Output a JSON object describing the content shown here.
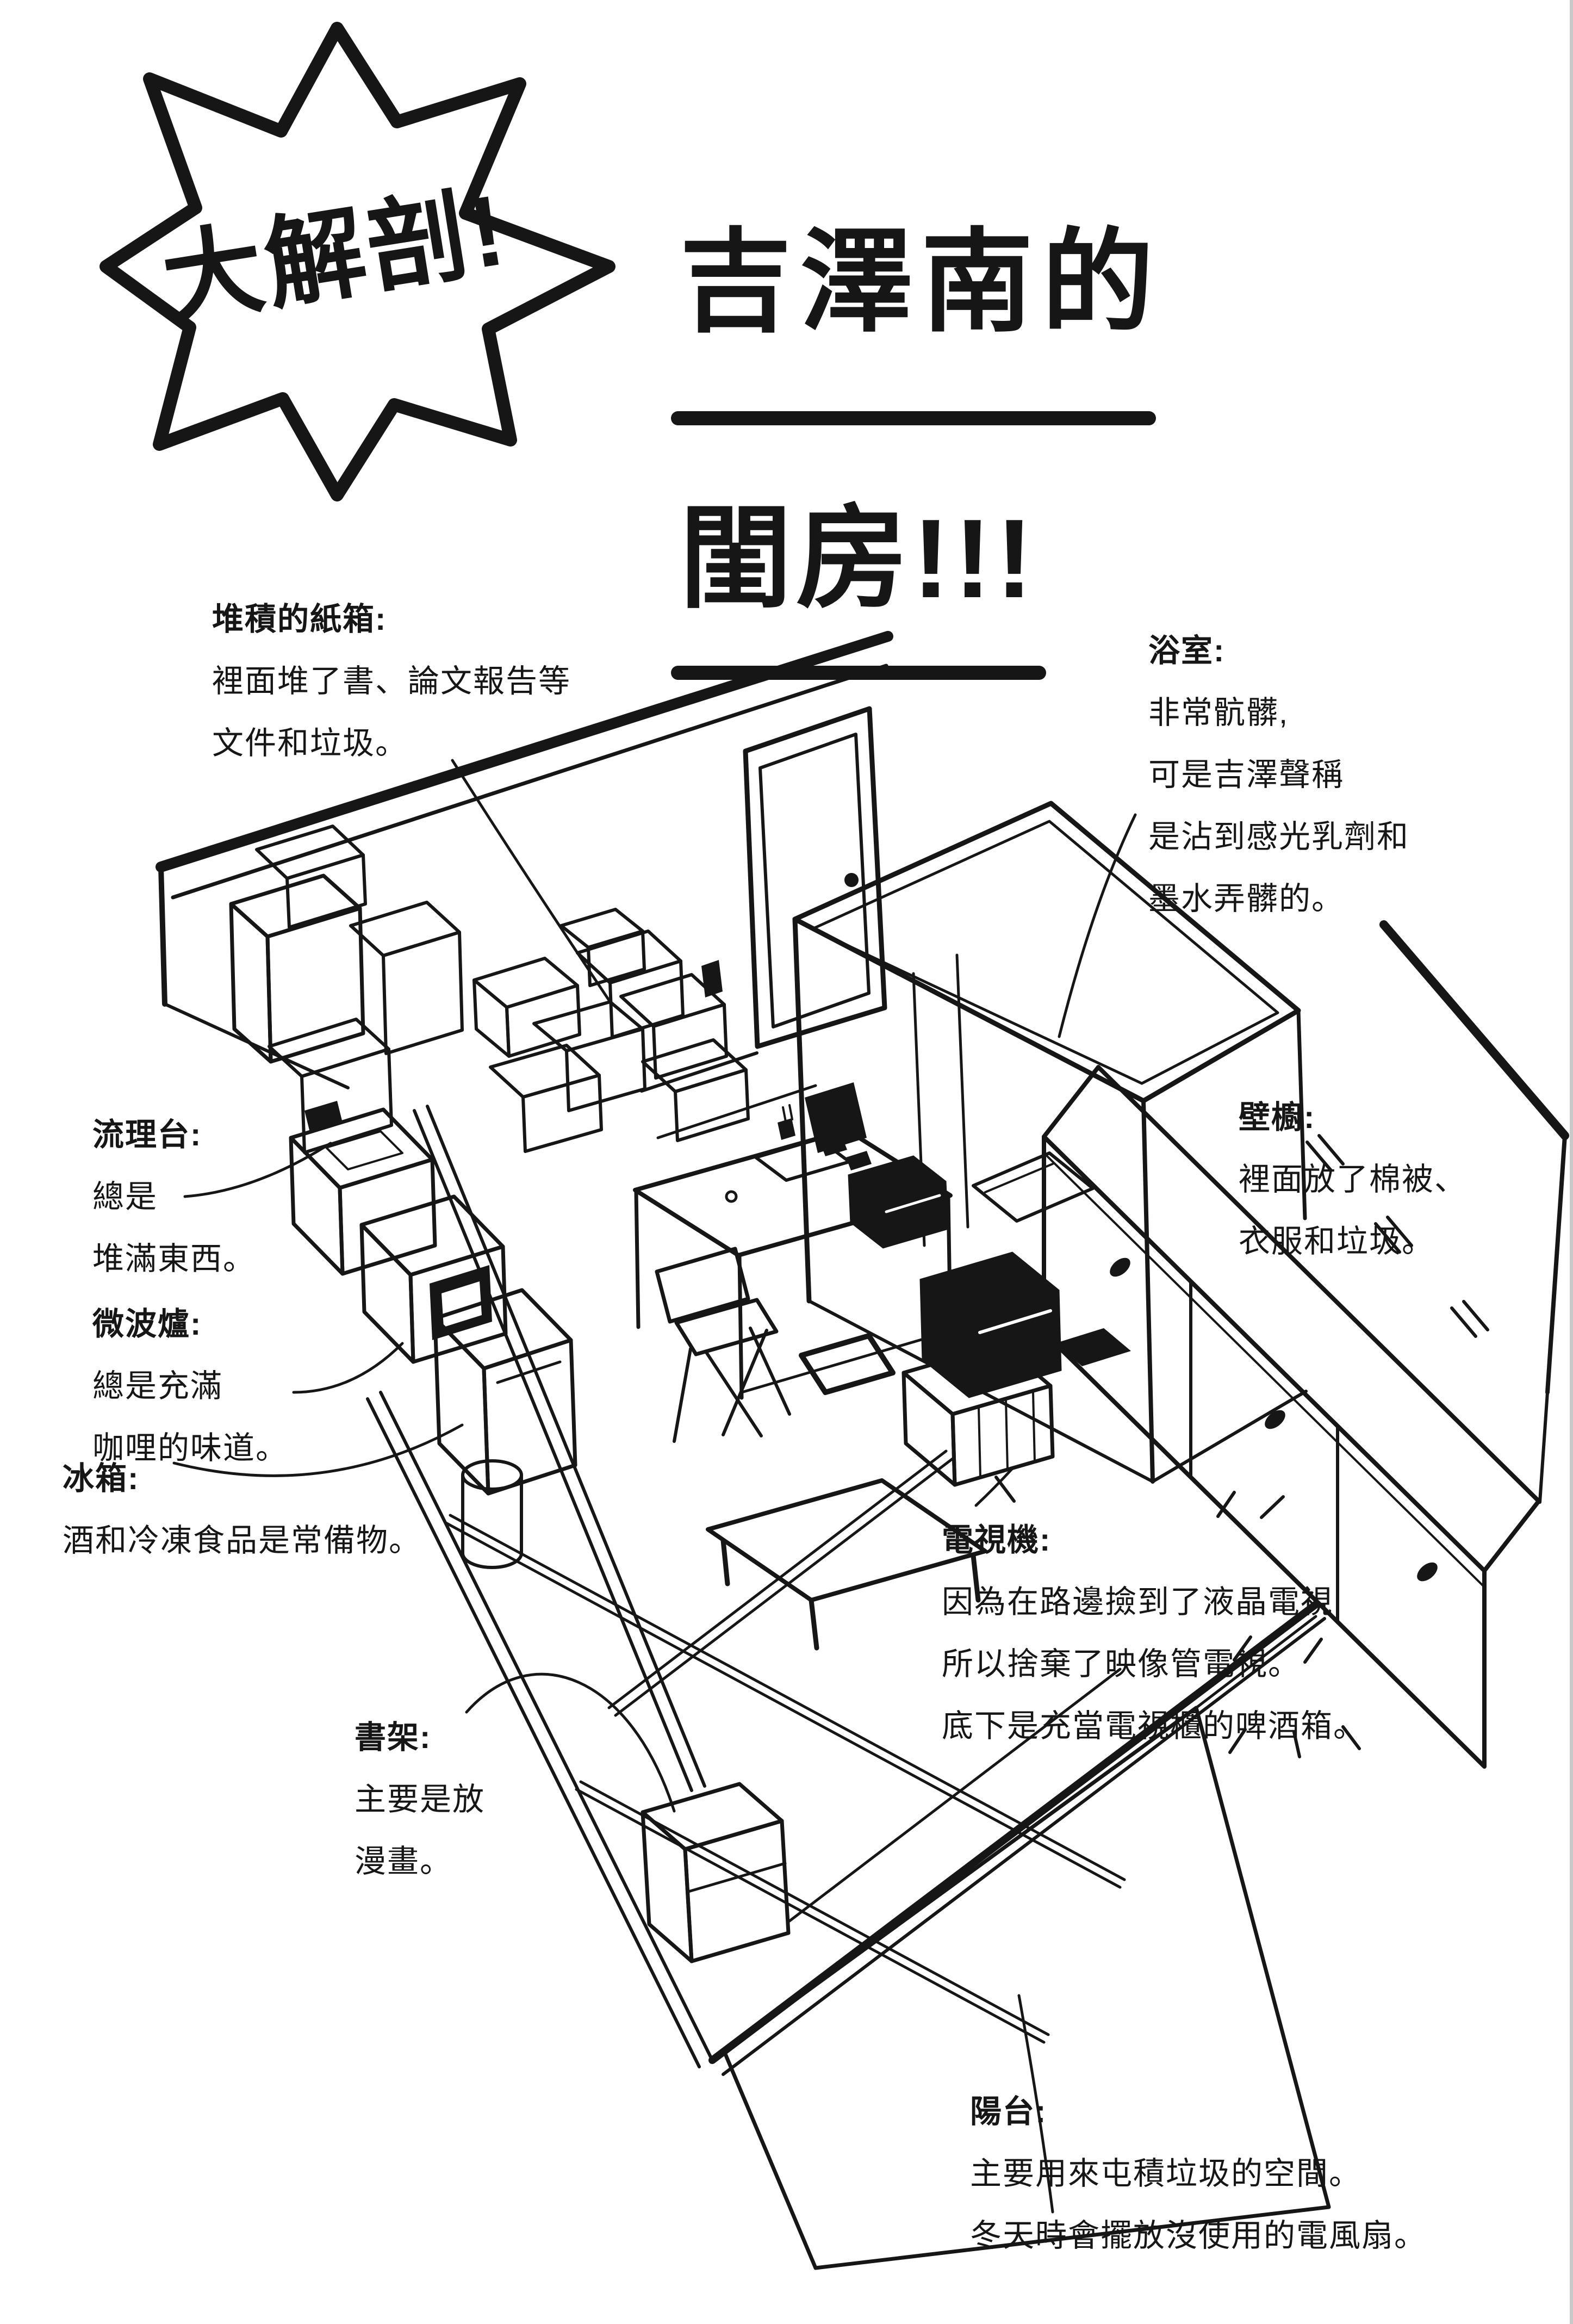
{
  "page": {
    "background": "#ffffff",
    "ink": "#161616"
  },
  "burst": {
    "label": "大解剖!"
  },
  "title": {
    "line1": "吉澤南的",
    "line2": "閨房!!!"
  },
  "annotations": [
    {
      "id": "stacked-boxes",
      "title": "堆積的紙箱:",
      "lines": [
        "裡面堆了書、論文報告等",
        "文件和垃圾。"
      ]
    },
    {
      "id": "bathroom",
      "title": "浴室:",
      "lines": [
        "非常骯髒,",
        "可是吉澤聲稱",
        "是沾到感光乳劑和",
        "墨水弄髒的。"
      ]
    },
    {
      "id": "sink",
      "title": "流理台:",
      "lines": [
        "總是",
        "堆滿東西。"
      ]
    },
    {
      "id": "closet",
      "title": "壁櫥:",
      "lines": [
        "裡面放了棉被、",
        "衣服和垃圾。"
      ]
    },
    {
      "id": "microwave",
      "title": "微波爐:",
      "lines": [
        "總是充滿",
        "咖哩的味道。"
      ]
    },
    {
      "id": "fridge",
      "title": "冰箱:",
      "lines": [
        "酒和冷凍食品是常備物。"
      ]
    },
    {
      "id": "tv",
      "title": "電視機:",
      "lines": [
        "因為在路邊撿到了液晶電視,",
        "所以捨棄了映像管電視。",
        "底下是充當電視櫃的啤酒箱。"
      ]
    },
    {
      "id": "bookshelf",
      "title": "書架:",
      "lines": [
        "主要是放",
        "漫畫。"
      ]
    },
    {
      "id": "balcony",
      "title": "陽台:",
      "lines": [
        "主要用來屯積垃圾的空間。",
        "冬天時會擺放沒使用的電風扇。"
      ]
    }
  ],
  "drawing": {
    "features": [
      "left-wall",
      "entrance-door",
      "bathroom-box",
      "closet-sliding-doors",
      "right-wall",
      "kitchen-counter",
      "microwave-oven",
      "refrigerator",
      "trash-cylinder",
      "carton-stacks",
      "carton-cluster",
      "desk",
      "folding-chair",
      "laptop",
      "printer",
      "tv-on-beer-crates",
      "floor-tablet",
      "low-table",
      "bookshelf",
      "tatami-floor",
      "balcony-slab"
    ]
  }
}
